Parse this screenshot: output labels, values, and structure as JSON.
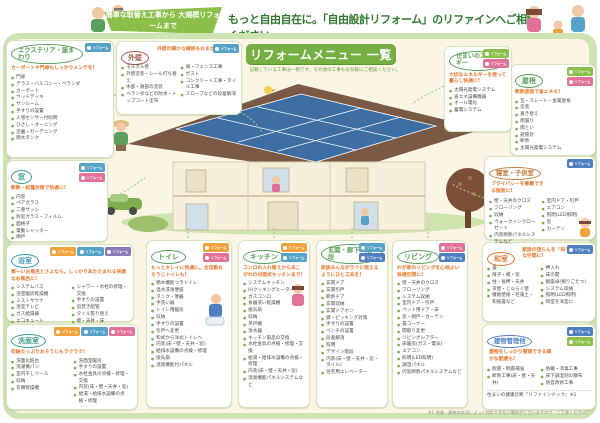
{
  "banner": {
    "ribbon": "簡単な取替え工事から 大規模リフォームまで",
    "headline": "もっと自由自在に。「自由設計リフォーム」のリファインへご相談ください。"
  },
  "title": {
    "main": "リフォームメニュー 一覧",
    "subtitle": "記載している工事は一例です。その他の工事もお気軽にご相談ください。"
  },
  "badge_label": "リフォーム",
  "footnote": "※1 地域・建物の状況によって対応できない場合がございますので、ご了承ください。",
  "categories": [
    {
      "title": "エクステリア・屋まわり",
      "title_color": "#5aa05a",
      "caption": "カーポートや門扉もしっかりメンテを!",
      "badges": [
        "#56a3c7"
      ],
      "items": [
        "門扉",
        "テラス・バルコニー・ベランダ",
        "カーポート",
        "ウッドデッキ",
        "サンルーム",
        "手すりの設置",
        "人感センサー付照明",
        "ひさし・オーニング",
        "造園・ガーデニング",
        "雨水タンク"
      ]
    },
    {
      "title": "外壁",
      "title_color": "#a8574e",
      "caption": "外壁の細かな補修もおまかせ!",
      "badges": [
        "#56a3c7"
      ],
      "items": [
        "モルタル壁",
        "外壁塗装・シール打ち替え",
        "木部・鉄部の塗装",
        "ベランダなどの防水・トップコート塗布"
      ],
      "items2": [
        "塀・フェンス工事",
        "ポスト",
        "コンクリート工事・タイル工事",
        "スロープなどの段差解消"
      ]
    },
    {
      "title": "窓",
      "title_color": "#3f9d8e",
      "caption": "断熱・結露対策で快適に!",
      "badges": [
        "#56a3c7",
        "#e2719a"
      ],
      "items": [
        "内窓",
        "ペアガラス",
        "二重サッシ",
        "防犯ガラス・フィルム",
        "面格子",
        "電動シャッター",
        "網戸"
      ]
    },
    {
      "title": "浴室",
      "title_color": "#3f9dbb",
      "caption": "寒〜いお風呂とさよなら。しっかりあたたまれる快適なお風呂に!",
      "badges": [
        "#f0a23c",
        "#56a3c7",
        "#8a7ab5"
      ],
      "items": [
        "システムバス",
        "浴室暖房乾燥機",
        "ミストサウナ",
        "浴室テレビ",
        "ガス給湯器",
        "エコキュート",
        "鏡のくもり・汚れ"
      ],
      "items2": [
        "シャワー・水栓の修理・交換",
        "手すりの設置",
        "追焚き配管",
        "タイル張り替え",
        "壁・天井・床"
      ]
    },
    {
      "title": "洗面室",
      "title_color": "#3f9d8e",
      "caption": "収納たっぷりおそうじもラクラク!",
      "badges": [
        "#f0a23c",
        "#56a3c7",
        "#e2719a"
      ],
      "items": [
        "洗面化粧台",
        "洗濯機パン",
        "室内干しツール",
        "収納",
        "衣類乾燥機"
      ],
      "items2": [
        "洗面室暖房",
        "手すりの設置",
        "水栓金具の点検・修理・交換",
        "内装(床・壁・天井・窓)",
        "給湯・給排水設備の点検・修理"
      ]
    },
    {
      "title": "トイレ",
      "title_color": "#5aa05a",
      "caption": "もっとキレイに快適に。全自動おそうじトイレも!",
      "badges": [
        "#f0a23c",
        "#e2719a"
      ],
      "items": [
        "節水機能つきトイレ",
        "温水洗浄便座",
        "タンク・便器",
        "手洗い器",
        "トイレ用暖房",
        "収納",
        "手すりの設置",
        "引戸へ変更",
        "和式から洋式トイレへ",
        "内装(床・壁・天井・窓)",
        "給排水設備の点検・修理",
        "換気扇",
        "消臭機能付パネル"
      ]
    },
    {
      "title": "キッチン",
      "title_color": "#5aa05a",
      "caption": "コンロの入れ替えからあこがれの対面式キッチンまで!",
      "badges": [
        "#f0a23c",
        "#56a3c7"
      ],
      "items": [
        "システムキッチン",
        "IHクッキングヒーター",
        "ガスコンロ",
        "食器洗い乾燥機",
        "換気扇",
        "収納",
        "吊戸棚",
        "浄水器",
        "キッチン部品の交換",
        "水栓金具の点検・修理・交換",
        "給湯・給排水設備の点検・修理",
        "内装(床・壁・天井・窓)",
        "消臭機能パネルシステムなど"
      ]
    },
    {
      "title": "玄関・廊下・階段",
      "title_color": "#5aa05a",
      "caption": "家族みんながラクに使えるようにひと工夫を!",
      "badges": [
        "#56a3c7",
        "#4f7fc0"
      ],
      "items": [
        "玄関ドア",
        "玄関引戸",
        "断熱ドア",
        "玄関収納",
        "玄関ドアホン",
        "鍵・ピッキング対策",
        "手すりの設置",
        "ベンチの設置",
        "段差解消",
        "照明",
        "デザイン階段",
        "内装(床・壁・天井・窓・タイル)",
        "住宅用エレベーター"
      ]
    },
    {
      "title": "リビング",
      "title_color": "#5aa05a",
      "caption": "わが家のリビングを心地よい快適空間に!",
      "badges": [
        "#e2719a",
        "#4f7fc0"
      ],
      "items": [
        "壁・天井のクロス",
        "フローリング",
        "システム収納",
        "室内ドア・引戸",
        "ペット用ドア・床",
        "窓・網戸・カーテン",
        "畳コーナー",
        "間取り変更",
        "リビングシアター",
        "床暖房(ガス・電気)",
        "エアコン",
        "照明(LED照明)",
        "調湿パネル",
        "内窓断熱パネルシステムなど"
      ]
    },
    {
      "title": "和室",
      "title_color": "#e07b39",
      "caption": "家族の団らんを「和モダン」な空間に!",
      "badges": [
        "#4f7fc0"
      ],
      "items": [
        "畳",
        "障子・襖・窓",
        "柱・長押・天井",
        "京壁・じゅらく壁",
        "機能壁紙・珪藻土・和紙畳など"
      ],
      "items2": [
        "押入れ",
        "床の間",
        "掘座卓(掘りごたつ)",
        "システム収納",
        "照明(LED照明)",
        "和室を洋室に"
      ]
    },
    {
      "title": "建物管理他",
      "title_color": "#4f7fc0",
      "caption": "建物をしっかり管理できる細かな配慮も!",
      "badges": [
        "#4f7fc0",
        "#8bbf4a"
      ],
      "items": [
        "耐震・制震補強",
        "断熱工事(床・壁・天井)"
      ],
      "items2": [
        "防蟻・消毒工事",
        "床下調湿剤の散布",
        "防音改修工事"
      ],
      "extra": "住まいの健康診断「リファインドック」※1"
    },
    {
      "title": "屋根",
      "title_color": "#5aa05a",
      "caption": "断熱塗装で省エネも!",
      "badges": [
        "#8bbf4a",
        "#e2719a"
      ],
      "items": [
        "瓦・スレート・金属屋根",
        "塗装",
        "葺き替え",
        "雨漏り",
        "雨とい",
        "避雷針",
        "断熱",
        "太陽光発電システム"
      ]
    },
    {
      "title": "住まいのエネルギー",
      "title_color": "#5aa05a",
      "caption": "大切なエネルギーを使って暮らし快適に!",
      "badges": [
        "#8bbf4a",
        "#e2719a"
      ],
      "items": [
        "太陽光発電システム",
        "省エネ設備機器",
        "オール電化",
        "蓄電システム"
      ]
    },
    {
      "title": "寝室・子供室",
      "title_color": "#c07a3e",
      "caption": "プライバシーを尊重できる個室に!",
      "badges": [
        "#4f7fc0"
      ],
      "items": [
        "壁・天井のクロス",
        "フローリング",
        "収納",
        "ウォークインクローゼット",
        "内装断熱パネルシステムなど"
      ],
      "items2": [
        "室内ドア・引戸",
        "エアコン",
        "照明(LED照明)",
        "窓",
        "カーテン"
      ]
    }
  ]
}
